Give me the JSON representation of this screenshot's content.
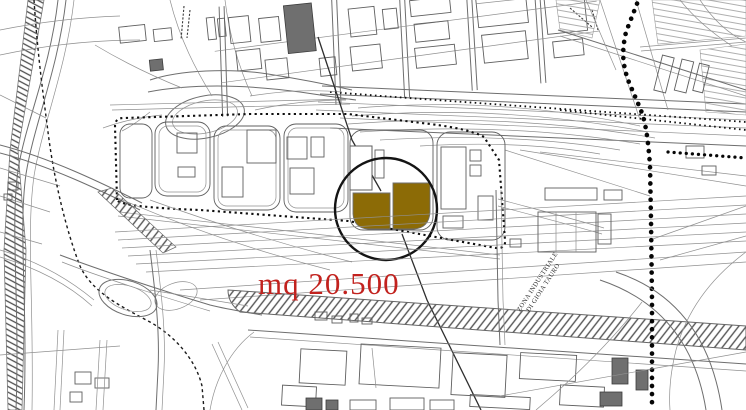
{
  "map": {
    "background_color": "#ffffff",
    "linework_color": "#6e6e6e",
    "boundary_dot_color": "#060606",
    "annotation": {
      "area_label": "mq 20.500",
      "area_label_color": "#c2221e"
    },
    "highlighted_parcel": {
      "fill_color": "#8c6b06",
      "outline_color": "#6e6e6e"
    },
    "highlight_circle_color": "#141414",
    "labels": {
      "zone_line1": "ZONA INDUSTRIALE",
      "zone_line2": "DI GIOIA TAURO"
    }
  }
}
